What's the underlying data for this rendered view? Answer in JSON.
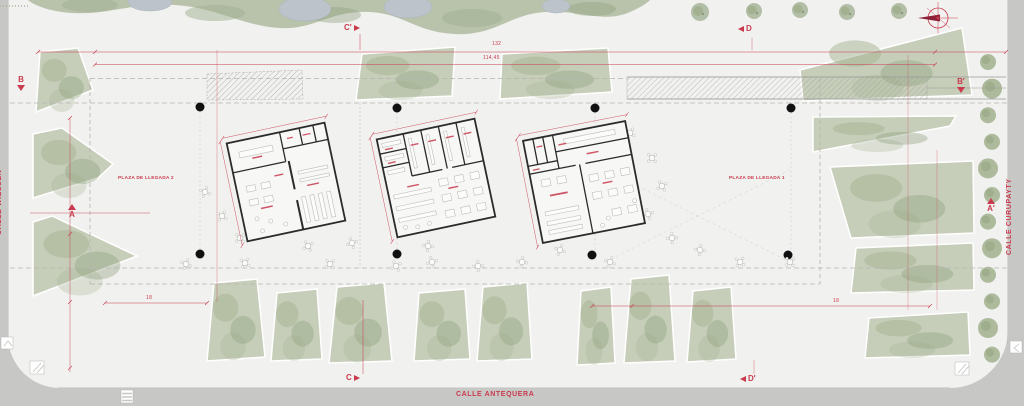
{
  "plan": {
    "streets": {
      "left": "CALLE WIESSEN",
      "right": "CALLE CURUPAYTY",
      "bottom": "CALLE ANTEQUERA"
    },
    "plazas": {
      "plaza_2": "PLAZA DE LLEGADA 2",
      "plaza_1": "PLAZA DE LLEGADA 1"
    },
    "section_markers": {
      "b_left": "B",
      "b_right": "B'",
      "a_left": "A",
      "a_right": "A'",
      "c_top": "C'",
      "c_bottom": "C",
      "d_top": "D",
      "d_bottom": "D'"
    },
    "dimensions": {
      "overall": "132",
      "inner": "114,45",
      "bay_left": "18",
      "bay_right": "18"
    },
    "icons": {
      "north_arrow": "crosshair-circle-with-arrow"
    },
    "colors": {
      "annotation_red": "#c93a4e",
      "road_gray": "#c7c7c5",
      "ground": "#f1f1ef",
      "vegetation": "#b9c3ac",
      "vegetation_dark": "#9aab88",
      "water": "#bcc3ca",
      "wall_black": "#2b2b2b"
    }
  }
}
